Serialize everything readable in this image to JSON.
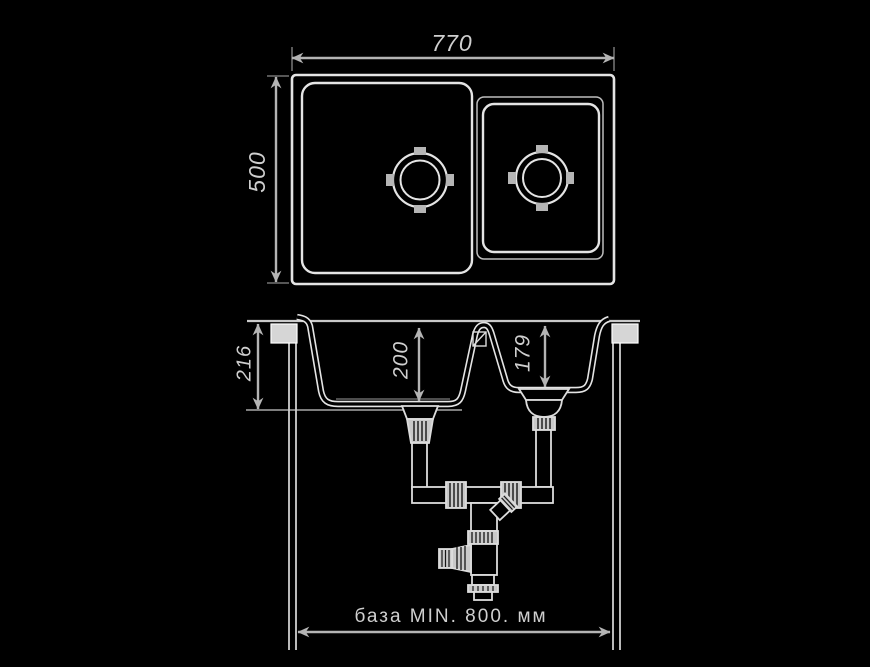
{
  "title": "Kitchen sink installation drawing (top view and cross-section)",
  "colors": {
    "background": "#000000",
    "drawing_line": "#e4e4e4",
    "dimension_line": "#b4b4b4",
    "text": "#cfcfcf",
    "countertop_block_fill": "#d6d6d6",
    "ribbed_part_fill": "#c9c9c9"
  },
  "dimensions": {
    "top_width_mm": "770",
    "top_depth_mm": "500",
    "section_overall_depth_mm": "216",
    "main_bowl_depth_mm": "200",
    "second_bowl_depth_mm": "179",
    "cabinet_base_note": "база MIN. 800. мм"
  }
}
